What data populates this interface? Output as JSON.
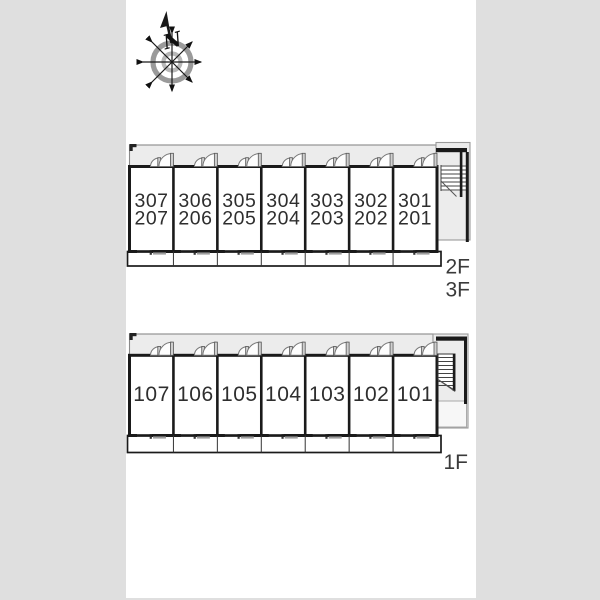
{
  "canvas": {
    "background": "#dfdfdf",
    "sheet": "#ffffff"
  },
  "colors": {
    "wall": "#1a1a1a",
    "corridor_fill": "#ececec",
    "door_leaf": "#cfcfcf",
    "window_mark": "#9e9e9e",
    "label_text": "#2e2e2e"
  },
  "compass": {
    "north_label": "N"
  },
  "upper_plan": {
    "name": "upper-floor-plan",
    "floor_labels": [
      "2F",
      "3F"
    ],
    "rooms": [
      {
        "line1": "307",
        "line2": "207"
      },
      {
        "line1": "306",
        "line2": "206"
      },
      {
        "line1": "305",
        "line2": "205"
      },
      {
        "line1": "304",
        "line2": "204"
      },
      {
        "line1": "303",
        "line2": "203"
      },
      {
        "line1": "302",
        "line2": "202"
      },
      {
        "line1": "301",
        "line2": "201"
      }
    ]
  },
  "lower_plan": {
    "name": "first-floor-plan",
    "floor_label": "1F",
    "rooms": [
      {
        "number": "107"
      },
      {
        "number": "106"
      },
      {
        "number": "105"
      },
      {
        "number": "104"
      },
      {
        "number": "103"
      },
      {
        "number": "102"
      },
      {
        "number": "101"
      }
    ]
  }
}
